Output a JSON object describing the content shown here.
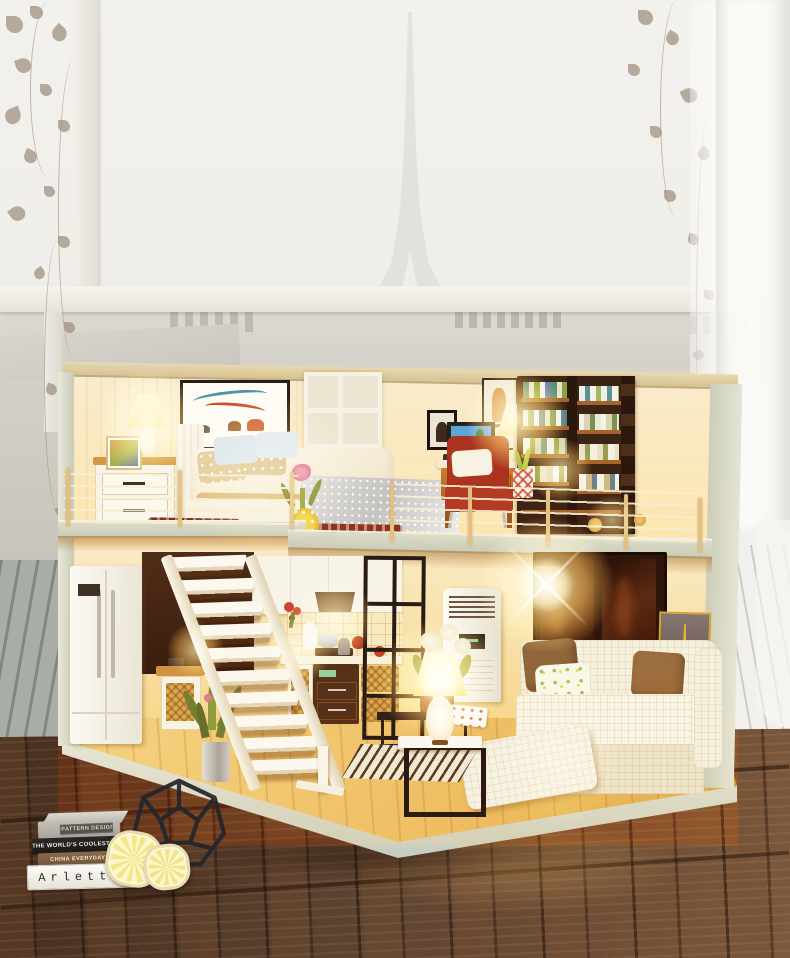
{
  "scene": {
    "subject": "DIY miniature dollhouse loft diorama (bedroom and study upstairs, kitchen and living room downstairs) glowing with warm lights, standing on a dark wooden table in front of a foggy Paris window with a faint Eiffel Tower",
    "palette": {
      "window_sky": "#f2f0ec",
      "rooftops": "#d7d4cc",
      "curtain": "#f8f7f4",
      "house_exterior": "#ccd3c9",
      "interior_wall": "#f8e9cc",
      "lamp_glow": "#ffc473",
      "floor_wood": "#eec27c",
      "table_wood": "#563b28",
      "stairs_white": "#f7f4ec",
      "accent_red": "#a03024",
      "metal_black": "#1b1c1e",
      "lemon_coaster": "#f2e787"
    }
  },
  "books": {
    "spines": [
      {
        "title": "PATTERN DESIGN"
      },
      {
        "title": "THE WORLD'S COOLEST HOTEL R"
      },
      {
        "title": "CHINA EVERYDAY!"
      },
      {
        "title": "Arletta"
      }
    ]
  }
}
